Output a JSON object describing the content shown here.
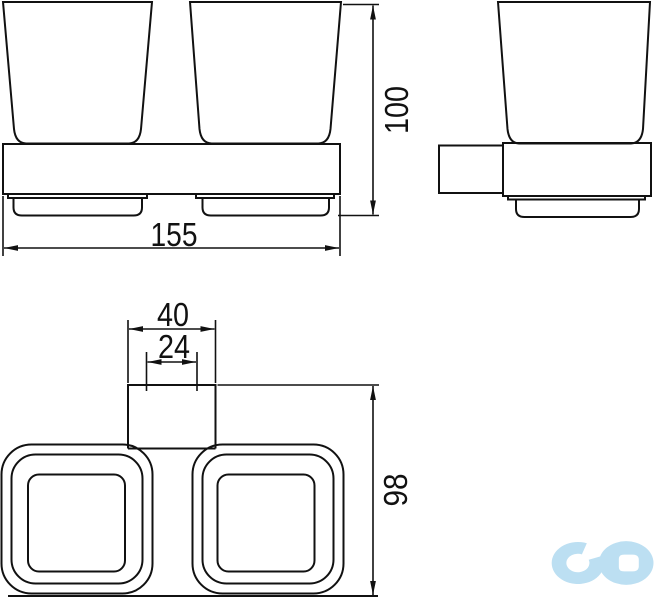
{
  "drawing": {
    "kind": "technical-dimension-drawing",
    "views": {
      "front": "front-view-double-tumbler",
      "side": "side-view-tumbler",
      "top": "top-view-double-tumbler"
    }
  },
  "dimensions": {
    "overall_width": "155",
    "overall_height": "100",
    "top_depth": "98",
    "bracket_width": "40",
    "bracket_inner_width": "24"
  },
  "colors": {
    "line": "#111111",
    "background": "#ffffff",
    "logo": "#bcdff2"
  },
  "logo": {
    "icon": "infinity-logo"
  }
}
